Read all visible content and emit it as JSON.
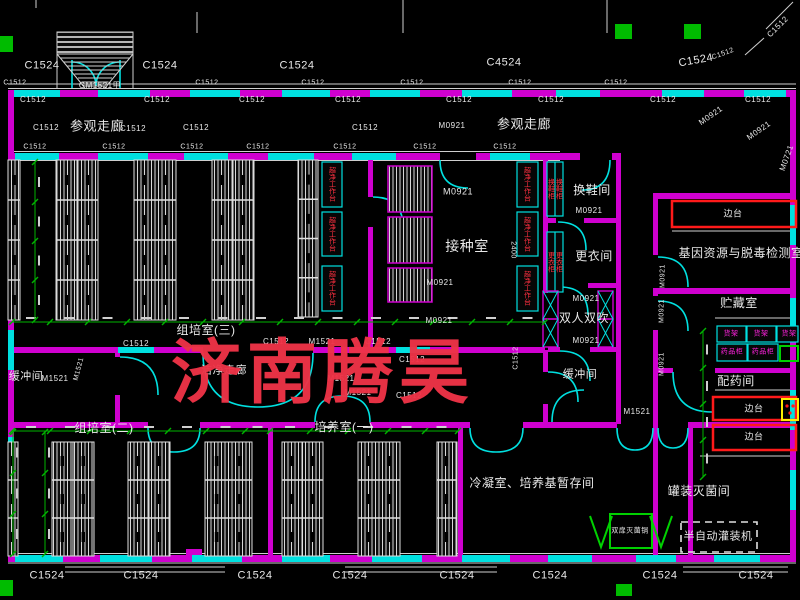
{
  "watermark": {
    "text": "济南腾昊",
    "color": "#ef3347"
  },
  "colors": {
    "wall": "#cf00cf",
    "window_door": "#00e0e0",
    "dimension": "#00b400",
    "lines": "#d2d2d2",
    "text": "#e8e8e8",
    "equipment_red": "#ff3040",
    "cabinet_text": "#ff22dd",
    "highlight_green": "#00cc00",
    "bench_red": "#ff1a1a",
    "yellow": "#ffee00"
  },
  "labels": [
    {
      "t": "C1524",
      "x": 42,
      "y": 66,
      "s": 11,
      "role": "window-code"
    },
    {
      "t": "C1524",
      "x": 160,
      "y": 66,
      "s": 11,
      "role": "window-code"
    },
    {
      "t": "C1524",
      "x": 297,
      "y": 66,
      "s": 11,
      "role": "window-code"
    },
    {
      "t": "C4524",
      "x": 504,
      "y": 63,
      "s": 11,
      "role": "window-code"
    },
    {
      "t": "C1524",
      "x": 696,
      "y": 61,
      "s": 11,
      "r": -10,
      "role": "window-code"
    },
    {
      "t": "C1512",
      "x": 723,
      "y": 54,
      "s": 7,
      "r": -20,
      "role": "window-code"
    },
    {
      "t": "C1512",
      "x": 778,
      "y": 27,
      "s": 8,
      "r": -45,
      "role": "window-code"
    },
    {
      "t": "GM1521甲",
      "x": 100,
      "y": 86,
      "s": 8,
      "role": "door-code"
    },
    {
      "t": "C1512",
      "x": 15,
      "y": 83,
      "s": 7,
      "role": "window-code"
    },
    {
      "t": "C1512",
      "x": 207,
      "y": 83,
      "s": 7,
      "role": "window-code"
    },
    {
      "t": "C1512",
      "x": 313,
      "y": 83,
      "s": 7,
      "role": "window-code"
    },
    {
      "t": "C1512",
      "x": 412,
      "y": 83,
      "s": 7,
      "role": "window-code"
    },
    {
      "t": "C1512",
      "x": 520,
      "y": 83,
      "s": 7,
      "role": "window-code"
    },
    {
      "t": "C1512",
      "x": 616,
      "y": 83,
      "s": 7,
      "role": "window-code"
    },
    {
      "t": "C1512",
      "x": 33,
      "y": 100,
      "s": 8,
      "role": "window-code"
    },
    {
      "t": "C1512",
      "x": 157,
      "y": 100,
      "s": 8,
      "role": "window-code"
    },
    {
      "t": "C1512",
      "x": 252,
      "y": 100,
      "s": 8,
      "role": "window-code"
    },
    {
      "t": "C1512",
      "x": 348,
      "y": 100,
      "s": 8,
      "role": "window-code"
    },
    {
      "t": "C1512",
      "x": 459,
      "y": 100,
      "s": 8,
      "role": "window-code"
    },
    {
      "t": "C1512",
      "x": 551,
      "y": 100,
      "s": 8,
      "role": "window-code"
    },
    {
      "t": "C1512",
      "x": 663,
      "y": 100,
      "s": 8,
      "role": "window-code"
    },
    {
      "t": "C1512",
      "x": 758,
      "y": 100,
      "s": 8,
      "role": "window-code"
    },
    {
      "t": "C1512",
      "x": 46,
      "y": 128,
      "s": 8,
      "role": "window-code"
    },
    {
      "t": "参观走廊",
      "x": 97,
      "y": 126,
      "s": 13,
      "role": "room"
    },
    {
      "t": "C1512",
      "x": 133,
      "y": 129,
      "s": 8,
      "role": "window-code"
    },
    {
      "t": "C1512",
      "x": 196,
      "y": 128,
      "s": 8,
      "role": "window-code"
    },
    {
      "t": "C1512",
      "x": 365,
      "y": 128,
      "s": 8,
      "role": "window-code"
    },
    {
      "t": "M0921",
      "x": 452,
      "y": 126,
      "s": 8,
      "role": "door-code"
    },
    {
      "t": "参观走廊",
      "x": 524,
      "y": 124,
      "s": 13,
      "role": "room"
    },
    {
      "t": "M0921",
      "x": 711,
      "y": 116,
      "s": 8,
      "r": -35,
      "role": "door-code"
    },
    {
      "t": "M0921",
      "x": 759,
      "y": 131,
      "s": 8,
      "r": -35,
      "role": "door-code"
    },
    {
      "t": "M0721",
      "x": 787,
      "y": 158,
      "s": 8,
      "r": -70,
      "role": "door-code"
    },
    {
      "t": "C1512",
      "x": 35,
      "y": 147,
      "s": 7,
      "role": "window-code"
    },
    {
      "t": "C1512",
      "x": 114,
      "y": 147,
      "s": 7,
      "role": "window-code"
    },
    {
      "t": "C1512",
      "x": 192,
      "y": 147,
      "s": 7,
      "role": "window-code"
    },
    {
      "t": "C1512",
      "x": 258,
      "y": 147,
      "s": 7,
      "role": "window-code"
    },
    {
      "t": "C1512",
      "x": 345,
      "y": 147,
      "s": 7,
      "role": "window-code"
    },
    {
      "t": "C1512",
      "x": 425,
      "y": 147,
      "s": 7,
      "role": "window-code"
    },
    {
      "t": "C1512",
      "x": 505,
      "y": 147,
      "s": 7,
      "role": "window-code"
    },
    {
      "t": "M0921",
      "x": 458,
      "y": 192,
      "s": 9,
      "role": "door-code"
    },
    {
      "t": "接种室",
      "x": 467,
      "y": 246,
      "s": 14,
      "role": "room"
    },
    {
      "t": "M0921",
      "x": 440,
      "y": 283,
      "s": 8,
      "role": "door-code"
    },
    {
      "t": "M0921",
      "x": 439,
      "y": 321,
      "s": 8,
      "role": "door-code"
    },
    {
      "t": "2400",
      "x": 513,
      "y": 250,
      "s": 7,
      "r": 90,
      "role": "dimension"
    },
    {
      "t": "换鞋间",
      "x": 592,
      "y": 190,
      "s": 12,
      "role": "room"
    },
    {
      "t": "M0921",
      "x": 589,
      "y": 211,
      "s": 8,
      "role": "door-code"
    },
    {
      "t": "更衣间",
      "x": 594,
      "y": 256,
      "s": 12,
      "role": "room"
    },
    {
      "t": "M0921",
      "x": 586,
      "y": 299,
      "s": 8,
      "role": "door-code"
    },
    {
      "t": "双人双吹",
      "x": 584,
      "y": 318,
      "s": 12,
      "role": "room"
    },
    {
      "t": "M0921",
      "x": 586,
      "y": 341,
      "s": 8,
      "role": "door-code"
    },
    {
      "t": "基因资源与脱毒检测室",
      "x": 741,
      "y": 253,
      "s": 12,
      "role": "room"
    },
    {
      "t": "边台",
      "x": 733,
      "y": 214,
      "s": 9,
      "role": "equipment"
    },
    {
      "t": "贮藏室",
      "x": 739,
      "y": 303,
      "s": 12,
      "role": "room"
    },
    {
      "t": "配药间",
      "x": 736,
      "y": 381,
      "s": 12,
      "role": "room"
    },
    {
      "t": "边台",
      "x": 754,
      "y": 409,
      "s": 9,
      "role": "equipment"
    },
    {
      "t": "边台",
      "x": 754,
      "y": 437,
      "s": 9,
      "role": "equipment"
    },
    {
      "t": "M0921",
      "x": 663,
      "y": 276,
      "s": 7,
      "r": -90,
      "role": "door-code"
    },
    {
      "t": "M0921",
      "x": 662,
      "y": 311,
      "s": 7,
      "r": -90,
      "role": "door-code"
    },
    {
      "t": "M0921",
      "x": 662,
      "y": 364,
      "s": 7,
      "r": -90,
      "role": "door-code"
    },
    {
      "t": "组培室(三)",
      "x": 206,
      "y": 330,
      "s": 12,
      "role": "room"
    },
    {
      "t": "C1512",
      "x": 136,
      "y": 344,
      "s": 8,
      "role": "window-code"
    },
    {
      "t": "C1512",
      "x": 276,
      "y": 342,
      "s": 8,
      "role": "window-code"
    },
    {
      "t": "M1521",
      "x": 322,
      "y": 342,
      "s": 8,
      "role": "door-code"
    },
    {
      "t": "C1512",
      "x": 378,
      "y": 342,
      "s": 8,
      "role": "window-code"
    },
    {
      "t": "C1512",
      "x": 412,
      "y": 360,
      "s": 8,
      "role": "window-code"
    },
    {
      "t": "缓冲间",
      "x": 26,
      "y": 377,
      "s": 11,
      "role": "room"
    },
    {
      "t": "M1521",
      "x": 55,
      "y": 379,
      "s": 8,
      "role": "door-code"
    },
    {
      "t": "M1521",
      "x": 79,
      "y": 369,
      "s": 7,
      "r": -75,
      "role": "door-code"
    },
    {
      "t": "洁净走廊",
      "x": 224,
      "y": 371,
      "s": 11,
      "role": "room"
    },
    {
      "t": "M1521",
      "x": 341,
      "y": 379,
      "s": 8,
      "role": "door-code"
    },
    {
      "t": "C1512",
      "x": 516,
      "y": 358,
      "s": 7,
      "r": -90,
      "role": "window-code"
    },
    {
      "t": "C1512",
      "x": 409,
      "y": 396,
      "s": 8,
      "role": "window-code"
    },
    {
      "t": "M1521",
      "x": 358,
      "y": 393,
      "s": 8,
      "role": "door-code"
    },
    {
      "t": "缓冲间",
      "x": 580,
      "y": 375,
      "s": 11,
      "role": "room"
    },
    {
      "t": "M1521",
      "x": 637,
      "y": 412,
      "s": 8,
      "role": "door-code"
    },
    {
      "t": "组培室(二)",
      "x": 104,
      "y": 428,
      "s": 12,
      "role": "room"
    },
    {
      "t": "培养室(一)",
      "x": 344,
      "y": 427,
      "s": 12,
      "role": "room"
    },
    {
      "t": "冷凝室、培养基暂存间",
      "x": 532,
      "y": 483,
      "s": 12,
      "role": "room"
    },
    {
      "t": "罐装灭菌间",
      "x": 699,
      "y": 491,
      "s": 12,
      "role": "room"
    },
    {
      "t": "半自动灌装机",
      "x": 718,
      "y": 537,
      "s": 11,
      "role": "equipment"
    },
    {
      "t": "双扉灭菌锅",
      "x": 630,
      "y": 531,
      "s": 7,
      "role": "equipment"
    },
    {
      "t": "C1524",
      "x": 47,
      "y": 576,
      "s": 11,
      "role": "window-code"
    },
    {
      "t": "C1524",
      "x": 141,
      "y": 576,
      "s": 11,
      "role": "window-code"
    },
    {
      "t": "C1524",
      "x": 255,
      "y": 576,
      "s": 11,
      "role": "window-code"
    },
    {
      "t": "C1524",
      "x": 350,
      "y": 576,
      "s": 11,
      "role": "window-code"
    },
    {
      "t": "C1524",
      "x": 457,
      "y": 576,
      "s": 11,
      "role": "window-code"
    },
    {
      "t": "C1524",
      "x": 550,
      "y": 576,
      "s": 11,
      "role": "window-code"
    },
    {
      "t": "C1524",
      "x": 660,
      "y": 576,
      "s": 11,
      "role": "window-code"
    },
    {
      "t": "C1524",
      "x": 756,
      "y": 576,
      "s": 11,
      "role": "window-code"
    },
    {
      "t": "超净工作台",
      "x": 527,
      "y": 184,
      "s": 7,
      "v": true,
      "c": "#ff3040",
      "role": "equipment"
    },
    {
      "t": "超净工作台",
      "x": 527,
      "y": 234,
      "s": 7,
      "v": true,
      "c": "#ff3040",
      "role": "equipment"
    },
    {
      "t": "超净工作台",
      "x": 527,
      "y": 288,
      "s": 7,
      "v": true,
      "c": "#ff3040",
      "role": "equipment"
    },
    {
      "t": "超净工作台",
      "x": 332,
      "y": 184,
      "s": 7,
      "v": true,
      "c": "#ff3040",
      "role": "equipment"
    },
    {
      "t": "超净工作台",
      "x": 332,
      "y": 234,
      "s": 7,
      "v": true,
      "c": "#ff3040",
      "role": "equipment"
    },
    {
      "t": "超净工作台",
      "x": 332,
      "y": 288,
      "s": 7,
      "v": true,
      "c": "#ff3040",
      "role": "equipment"
    },
    {
      "t": "换鞋柜",
      "x": 551,
      "y": 189,
      "s": 7,
      "v": true,
      "c": "#ff3040",
      "role": "equipment"
    },
    {
      "t": "换鞋柜",
      "x": 559,
      "y": 189,
      "s": 7,
      "v": true,
      "c": "#ff3040",
      "role": "equipment"
    },
    {
      "t": "更衣柜",
      "x": 551,
      "y": 262,
      "s": 7,
      "v": true,
      "c": "#ff3040",
      "role": "equipment"
    },
    {
      "t": "更衣柜",
      "x": 559,
      "y": 262,
      "s": 7,
      "v": true,
      "c": "#ff3040",
      "role": "equipment"
    },
    {
      "t": "货架",
      "x": 731,
      "y": 334,
      "s": 7,
      "c": "#ff22dd",
      "role": "equipment"
    },
    {
      "t": "货架",
      "x": 761,
      "y": 334,
      "s": 7,
      "c": "#ff22dd",
      "role": "equipment"
    },
    {
      "t": "货架",
      "x": 789,
      "y": 334,
      "s": 7,
      "c": "#ff22dd",
      "role": "equipment"
    },
    {
      "t": "药品柜",
      "x": 732,
      "y": 352,
      "s": 7,
      "c": "#ff22dd",
      "role": "equipment"
    },
    {
      "t": "药品柜",
      "x": 763,
      "y": 352,
      "s": 7,
      "c": "#ff22dd",
      "role": "equipment"
    }
  ]
}
